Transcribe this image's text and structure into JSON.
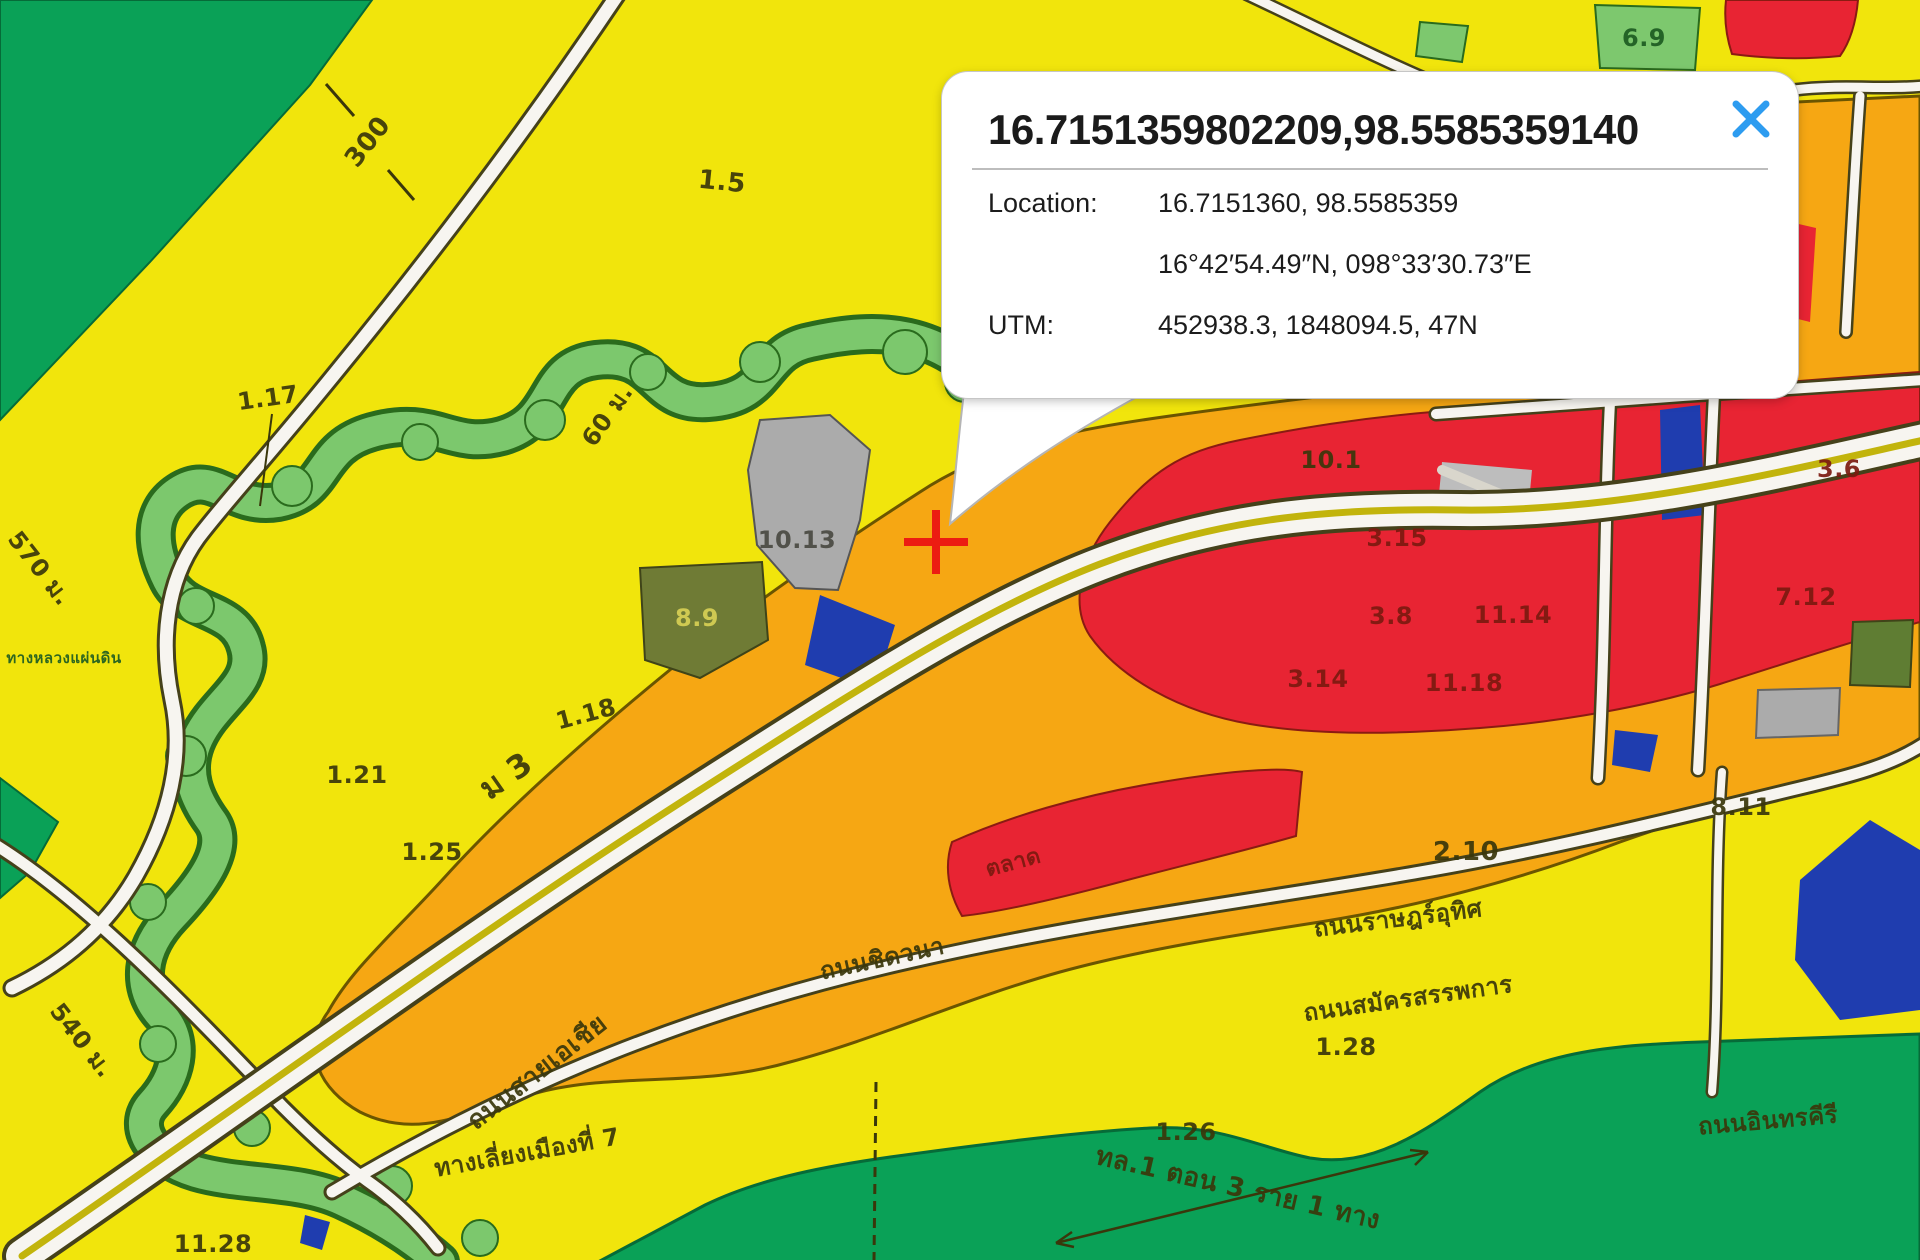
{
  "popup": {
    "title": "16.7151359802209,98.5585359140",
    "close_icon": "close-icon",
    "rows": [
      {
        "label": "Location:",
        "value": "16.7151360, 98.5585359"
      },
      {
        "label": "",
        "value": "16°42′54.49″N, 098°33′30.73″E"
      },
      {
        "label": "UTM:",
        "value": "452938.3, 1848094.5, 47N"
      }
    ]
  },
  "marker": {
    "x": 936,
    "y": 542,
    "color": "#ec1c12"
  },
  "map": {
    "colors": {
      "residential_yellow": "#f1e50c",
      "rural_green": "#0aa157",
      "stream_green": "#7cc86d",
      "commercial_orange": "#f6a713",
      "commercial_red": "#e82433",
      "institution_blue": "#1f3daf",
      "utility_gray": "#ababab",
      "military_olive": "#6f7b35",
      "road_white": "#f7f5f0",
      "close_blue": "#2d9cf0",
      "marker_red": "#ec1c12"
    },
    "labels": [
      {
        "t": "300",
        "x": 368,
        "y": 142,
        "r": -52,
        "s": 26,
        "c": "#3a370b"
      },
      {
        "t": "1.5",
        "x": 722,
        "y": 182,
        "r": 6,
        "s": 26,
        "c": "#3a370b"
      },
      {
        "t": "1.17",
        "x": 268,
        "y": 398,
        "r": -8,
        "s": 24,
        "c": "#3a370b"
      },
      {
        "t": "60 ม.",
        "x": 607,
        "y": 415,
        "r": -55,
        "s": 24,
        "c": "#3a370b"
      },
      {
        "t": "10.13",
        "x": 797,
        "y": 540,
        "r": 0,
        "s": 24,
        "c": "#4a4a42"
      },
      {
        "t": "8.9",
        "x": 697,
        "y": 618,
        "r": 0,
        "s": 24,
        "c": "#d8d055"
      },
      {
        "t": "ม 3",
        "x": 506,
        "y": 776,
        "r": -35,
        "s": 32,
        "c": "#3a370b"
      },
      {
        "t": "1.18",
        "x": 586,
        "y": 714,
        "r": -15,
        "s": 24,
        "c": "#3a370b"
      },
      {
        "t": "1.21",
        "x": 357,
        "y": 775,
        "r": 0,
        "s": 24,
        "c": "#3a370b"
      },
      {
        "t": "1.25",
        "x": 432,
        "y": 852,
        "r": 0,
        "s": 24,
        "c": "#3a370b"
      },
      {
        "t": "570 ม.",
        "x": 40,
        "y": 568,
        "r": 52,
        "s": 24,
        "c": "#3a370b"
      },
      {
        "t": "ทางหลวงแผ่นดิน",
        "x": 64,
        "y": 658,
        "r": 0,
        "s": 15,
        "c": "#1d5c22"
      },
      {
        "t": "540 ม.",
        "x": 82,
        "y": 1040,
        "r": 52,
        "s": 24,
        "c": "#3a370b"
      },
      {
        "t": "11.28",
        "x": 213,
        "y": 1244,
        "r": 0,
        "s": 24,
        "c": "#3a370b"
      },
      {
        "t": "ถนนสายเอเชีย",
        "x": 537,
        "y": 1072,
        "r": -38,
        "s": 26,
        "c": "#3a370b"
      },
      {
        "t": "ทางเลี่ยงเมืองที่ 7",
        "x": 527,
        "y": 1152,
        "r": -10,
        "s": 24,
        "c": "#3a370b"
      },
      {
        "t": "ถนนชิดวนา",
        "x": 882,
        "y": 958,
        "r": -12,
        "s": 24,
        "c": "#3a370b"
      },
      {
        "t": "ตลาด",
        "x": 1013,
        "y": 862,
        "r": -15,
        "s": 22,
        "c": "#7c1a10"
      },
      {
        "t": "10.1",
        "x": 1331,
        "y": 460,
        "r": 0,
        "s": 24,
        "c": "#3a370b"
      },
      {
        "t": "3.15",
        "x": 1397,
        "y": 538,
        "r": 0,
        "s": 24,
        "c": "#7c1a10"
      },
      {
        "t": "3.8",
        "x": 1391,
        "y": 616,
        "r": 0,
        "s": 24,
        "c": "#7c1a10"
      },
      {
        "t": "11.14",
        "x": 1513,
        "y": 615,
        "r": 0,
        "s": 24,
        "c": "#7c1a10"
      },
      {
        "t": "3.14",
        "x": 1318,
        "y": 679,
        "r": 0,
        "s": 24,
        "c": "#7c1a10"
      },
      {
        "t": "11.18",
        "x": 1464,
        "y": 683,
        "r": 0,
        "s": 24,
        "c": "#7c1a10"
      },
      {
        "t": "7.12",
        "x": 1806,
        "y": 597,
        "r": 0,
        "s": 24,
        "c": "#7c1a10"
      },
      {
        "t": "3.6",
        "x": 1839,
        "y": 469,
        "r": 0,
        "s": 24,
        "c": "#7c1a10"
      },
      {
        "t": "2.10",
        "x": 1466,
        "y": 852,
        "r": 0,
        "s": 26,
        "c": "#3a370b"
      },
      {
        "t": "8.11",
        "x": 1741,
        "y": 807,
        "r": 0,
        "s": 24,
        "c": "#3a370b"
      },
      {
        "t": "6.9",
        "x": 1644,
        "y": 38,
        "r": 0,
        "s": 24,
        "c": "#1d5c22"
      },
      {
        "t": "ถนนราษฎร์อุทิศ",
        "x": 1398,
        "y": 918,
        "r": -7,
        "s": 24,
        "c": "#3a370b"
      },
      {
        "t": "ถนนสมัครสรรพการ",
        "x": 1408,
        "y": 998,
        "r": -8,
        "s": 24,
        "c": "#3a370b"
      },
      {
        "t": "ถนนอินทรคีรี",
        "x": 1768,
        "y": 1120,
        "r": -5,
        "s": 24,
        "c": "#3a370b"
      },
      {
        "t": "1.26",
        "x": 1186,
        "y": 1132,
        "r": 0,
        "s": 24,
        "c": "#3a370b"
      },
      {
        "t": "1.28",
        "x": 1346,
        "y": 1047,
        "r": 0,
        "s": 24,
        "c": "#3a370b"
      },
      {
        "t": "ทล.1 ตอน 3 ราย 1 ทาง",
        "x": 1238,
        "y": 1188,
        "r": 13,
        "s": 26,
        "c": "#3a370b"
      }
    ]
  }
}
